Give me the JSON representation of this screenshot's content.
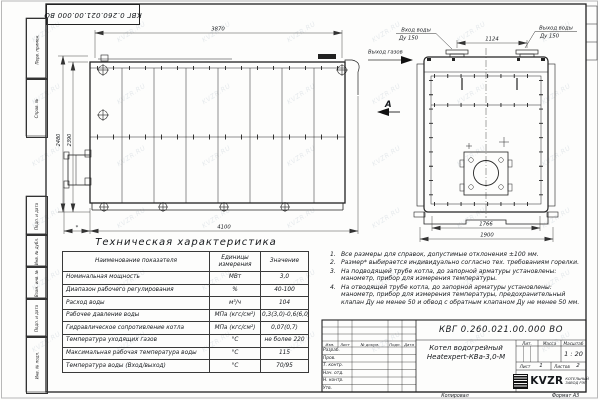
{
  "sheet": {
    "stamp_top": "КВГ 0.260.021.00.000 ВО",
    "watermark": "KVZR.RU",
    "copied_label": "Копировал",
    "format_label": "Формат А3",
    "margin_labels": [
      "Перв. примен.",
      "Справ. №",
      "Подп. и дата",
      "Инв. № дубл.",
      "Взам. инв. №",
      "Подп. и дата",
      "Инв. № подл."
    ]
  },
  "drawing": {
    "side_view": {
      "dim_top": "3870",
      "dim_height_outer": "2480",
      "dim_height_inner": "2390",
      "dim_bottom": "4100",
      "dim_burner": "*"
    },
    "front_view": {
      "water_inlet_label": "Вход воды",
      "water_inlet_dn": "Ду 150",
      "water_outlet_label": "Выход воды",
      "water_outlet_dn": "Ду 150",
      "dim_flange_spacing": "1124",
      "dim_width_inner": "1766",
      "dim_width_outer": "1900"
    },
    "gas_outlet_label": "Выход газов",
    "view_arrow_label": "А"
  },
  "tech_table": {
    "title": "Техническая характеристика",
    "headers": [
      "Наименование показателя",
      "Единицы измерения",
      "Значение"
    ],
    "rows": [
      [
        "Номинальная мощность",
        "МВт",
        "3,0"
      ],
      [
        "Диапазон рабочего регулирования",
        "%",
        "40-100"
      ],
      [
        "Расход воды",
        "м³/ч",
        "104"
      ],
      [
        "Рабочее давление воды",
        "МПа (кгс/см²)",
        "0,3(3,0)-0,6(6,0)"
      ],
      [
        "Гидравлическое сопротивление котла",
        "МПа (кгс/см²)",
        "0,07(0,7)"
      ],
      [
        "Температура уходящих газов",
        "°С",
        "не более 220"
      ],
      [
        "Максимальная рабочая температура воды",
        "°С",
        "115"
      ],
      [
        "Температура воды (Вход/выход)",
        "°С",
        "70/95"
      ]
    ]
  },
  "notes": [
    {
      "num": "1.",
      "text": "Все размеры для справок, допустимые отклонения ±100 мм."
    },
    {
      "num": "2.",
      "text": "Размер* выбирается индивидуально согласно тех. требованиям горелки."
    },
    {
      "num": "3.",
      "text": "На подводящей трубе котла, до запорной арматуры установлены: манометр, прибор для измерения температуры."
    },
    {
      "num": "4.",
      "text": "На отводящей трубе котла, до запорной арматуры установлены: манометр, прибор для измерения температуры, предохранительный клапан Ду не менее 50 и обвод с обратным клапаном Ду не менее 50 мм."
    }
  ],
  "title_block": {
    "doc_number": "КВГ 0.260.021.00.000 ВО",
    "product_line1": "Котел водогрейный",
    "product_line2": "Heatexpert-КВа-3,0-М",
    "col_headers": [
      "Изм.",
      "Лист",
      "№ докум.",
      "Подп.",
      "Дата"
    ],
    "row_labels": [
      "Разраб.",
      "Пров.",
      "Т. контр.",
      "Нач. отд.",
      "Н. контр.",
      "Утв."
    ],
    "lit_label": "Лит.",
    "mass_label": "Масса",
    "scale_label": "Масштаб",
    "scale_value": "1 : 20",
    "sheet_label": "Лист",
    "sheet_value": "1",
    "sheets_label": "Листов",
    "sheets_value": "2",
    "logo_text": "KVZR",
    "company_line1": "КОТЕЛЬНЫЙ",
    "company_line2": "ЗАВОД РЭП"
  }
}
